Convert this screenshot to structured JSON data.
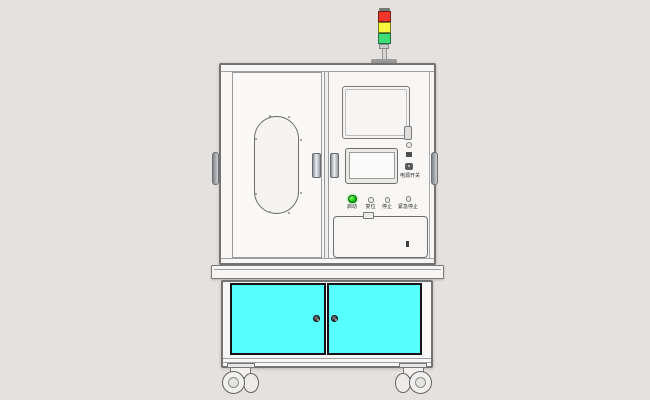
{
  "scene": {
    "background": "#e4e1de",
    "description": "Front CAD render of an automated machine on a caster base cabinet"
  },
  "tower_light": {
    "segments": [
      {
        "name": "red",
        "color": "#f1372b"
      },
      {
        "name": "yellow",
        "color": "#f6f63c"
      },
      {
        "name": "green",
        "color": "#3edd7a"
      }
    ],
    "pole_color": "#d6d5d3",
    "base_color": "#9a9a9a"
  },
  "machine": {
    "body_color": "#f8f7f5",
    "control_panel": {
      "power_switch_label": "电源开关",
      "buttons": [
        {
          "label": "启动",
          "color": "#16cd16"
        },
        {
          "label": "复位",
          "color": "#ecebe8"
        },
        {
          "label": "停止",
          "color": "#ecebe8"
        },
        {
          "label": "紧急停止",
          "color": "#ecebe8"
        }
      ]
    }
  },
  "base_cabinet": {
    "door_color": "#58ffff",
    "knob_color": "#2b2b2b"
  }
}
